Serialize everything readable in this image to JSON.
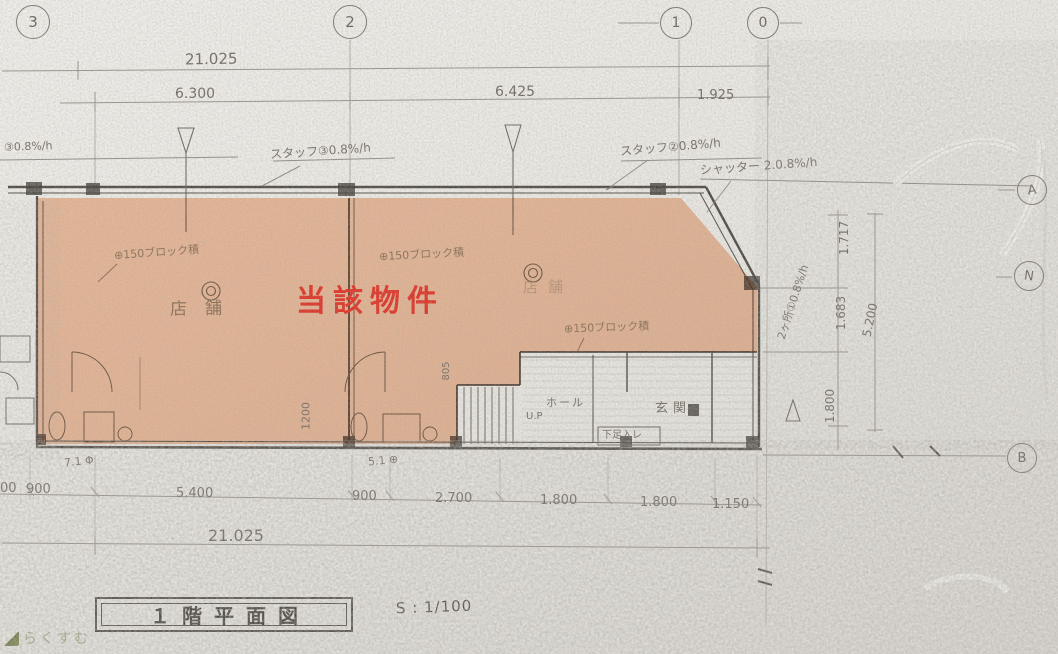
{
  "document": {
    "type": "scanned architectural floor plan",
    "title": "１階平面図",
    "scale": "S : 1/100",
    "highlight": {
      "label": "当該物件",
      "text_color": "#e03226",
      "area_color": "#f09f6e"
    },
    "watermark": {
      "text": "らくすむ"
    }
  },
  "grid_bubbles": {
    "top": [
      {
        "label": "3"
      },
      {
        "label": "2"
      },
      {
        "label": "1"
      },
      {
        "label": "0"
      }
    ],
    "right": [
      {
        "label": "A"
      },
      {
        "label": "N"
      },
      {
        "label": "B"
      }
    ]
  },
  "dimensions": {
    "top_total": "21.025",
    "top_segments": [
      "6.300",
      "6.425",
      "1.925"
    ],
    "bottom_segments": [
      "00",
      "900",
      "5.400",
      "900",
      "2.700",
      "1.800",
      "1.800",
      "1.150"
    ],
    "bottom_total": "21.025",
    "right_segments": [
      "1.717",
      "1.683",
      "1.800"
    ],
    "right_total": "5.200",
    "interior": [
      "1200",
      "805"
    ]
  },
  "rooms": {
    "shop_left": "店舗",
    "shop_right": "店舗",
    "hall": "ホール",
    "up": "U.P",
    "entrance": "玄関",
    "shoe_box": "下足入レ"
  },
  "notes": {
    "top_left": "③0.8%/h",
    "top_mid": "スタッフ③0.8%/h",
    "top_right": "スタッフ②0.8%/h",
    "shutter": "シャッター 2.0.8%/h",
    "right_diag": "2ヶ所①0.8%/h",
    "block_wall_1": "⊕150ブロック積",
    "block_wall_2": "⊕150ブロック積",
    "block_wall_3": "⊕150ブロック積",
    "small_left": "7.1 Φ",
    "small_mid": "5.1 ⊕"
  }
}
